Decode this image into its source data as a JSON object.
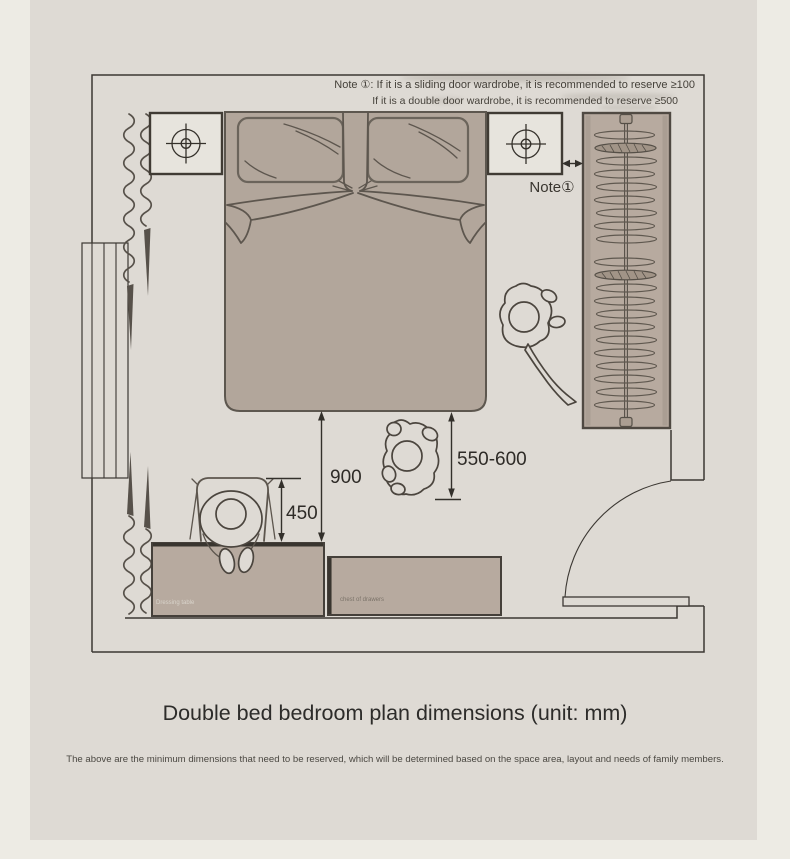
{
  "page": {
    "title": "Double bed bedroom plan dimensions (unit: mm)",
    "subtitle": "The above are the minimum dimensions that need to be reserved, which will be determined based on the space area, layout and needs of family members."
  },
  "notes": {
    "line1": "Note ①: If it is a sliding door wardrobe, it is recommended to reserve ≥100",
    "line2": "If it is a double door wardrobe, it is recommended to reserve ≥500",
    "pointer": "Note①"
  },
  "dimensions": {
    "bed_to_dressing_table": "900",
    "chair_clearance": "450",
    "bed_side_walkway": "550-600"
  },
  "furniture_labels": {
    "dressing_table": "Dressing table",
    "chest_of_drawers": "chest of drawers"
  },
  "icons": {
    "bedside_lamp": "crosshair-circle",
    "curtain": "wavy-line-with-tassel",
    "door_swing": "quarter-arc",
    "clothes_hanger": "flat-ellipse"
  },
  "colors": {
    "canvas": "#dedad4",
    "page_margin": "#edebe4",
    "furniture": "#b7aa9f",
    "bed": "#b2a69b",
    "nightstand": "#e7e4dd",
    "wall_line": "#3c3833",
    "sketch_line": "#5d564e",
    "text_dark": "#2e2b27",
    "text_mid": "#45413a",
    "label_light": "#d9d4cb"
  }
}
